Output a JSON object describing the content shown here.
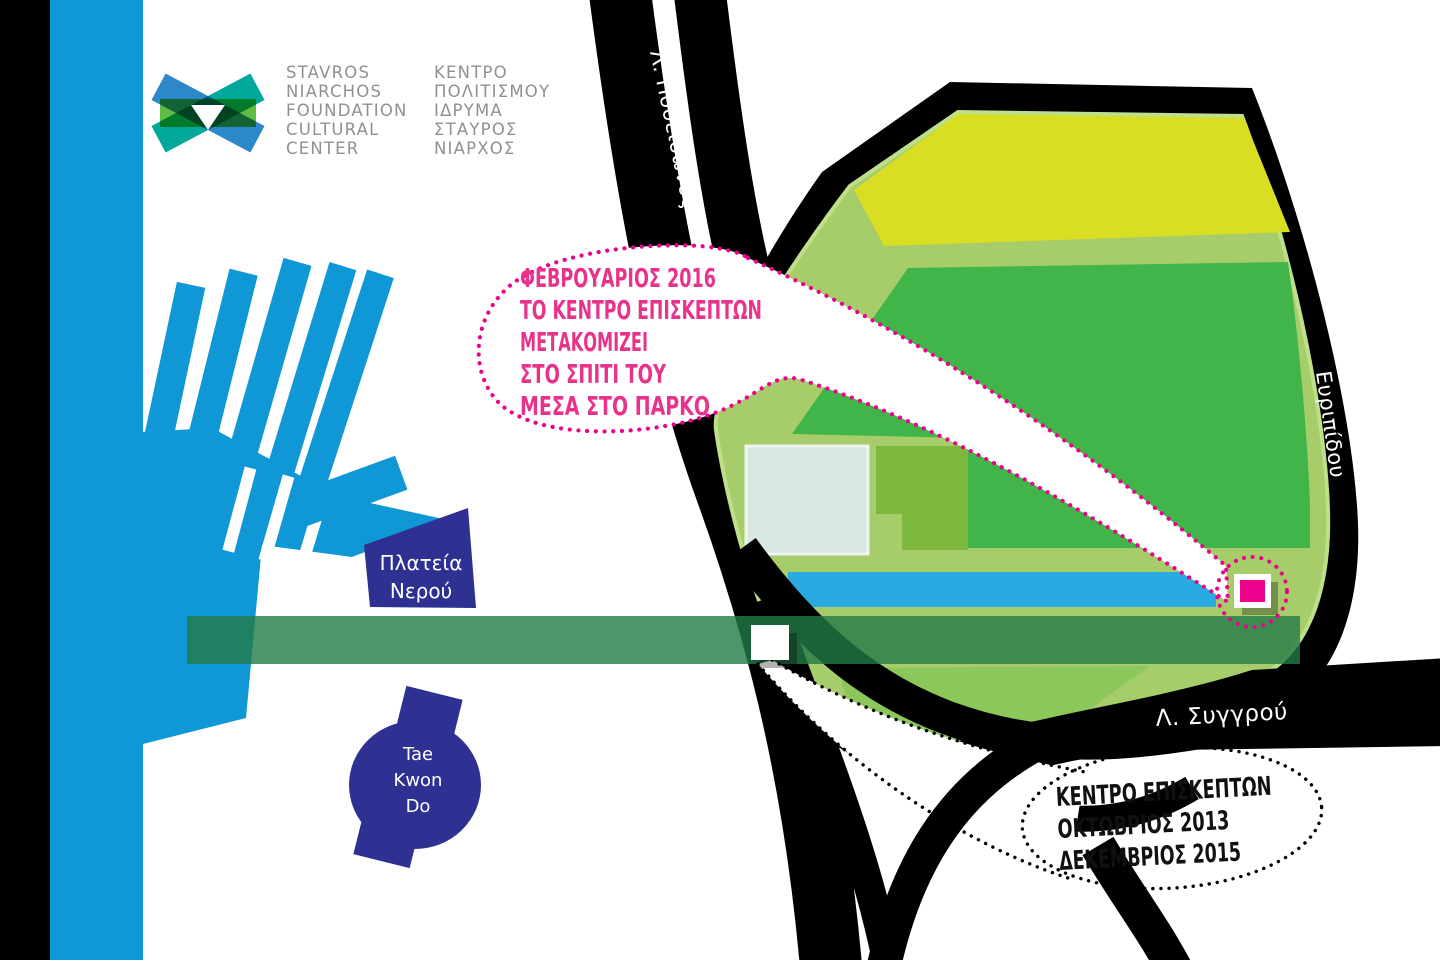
{
  "logo": {
    "name_en": [
      "STAVROS",
      "NIARCHOS",
      "FOUNDATION",
      "CULTURAL",
      "CENTER"
    ],
    "name_el": [
      "ΚΕΝΤΡΟ",
      "ΠΟΛΙΤΙΣΜΟΥ",
      "ΙΔΡΥΜΑ",
      "ΣΤΑΥΡΟΣ",
      "ΝΙΑΡΧΟΣ"
    ]
  },
  "roads": {
    "poseidonos": "Λ. Ποσειδώνος",
    "evripidou": "Ευριπίδου",
    "syggrou": "Λ. Συγγρού"
  },
  "places": {
    "plateia_nerou": {
      "lines": [
        "Πλατεία",
        "Νερού"
      ]
    },
    "tae_kwon_do": {
      "lines": [
        "Tae",
        "Kwon",
        "Do"
      ]
    }
  },
  "callouts": {
    "pink": {
      "lines": [
        "ΦΕΒΡΟΥΑΡΙΟΣ 2016",
        "ΤΟ ΚΕΝΤΡΟ ΕΠΙΣΚΕΠΤΩΝ",
        "ΜΕΤΑΚΟΜΙΖΕΙ",
        "ΣΤΟ ΣΠΙΤΙ ΤΟΥ",
        "ΜΕΣΑ ΣΤΟ ΠΑΡΚΟ"
      ]
    },
    "black": {
      "lines": [
        "ΚΕΝΤΡΟ ΕΠΙΣΚΕΠΤΩΝ",
        "ΟΚΤΩΒΡΙΟΣ 2013",
        "ΔΕΚΕΜΒΡΙΟΣ 2015"
      ]
    }
  },
  "colors": {
    "water_blue": "#1097d5",
    "road_black": "#000000",
    "park_light_green": "#a7cd6a",
    "park_border_green": "#bfdf8a",
    "park_yellow": "#dade22",
    "park_mid_green": "#41b549",
    "park_low_green": "#8cc75b",
    "building_pale": "#d9e9e2",
    "building_olive": "#7db93e",
    "canal_blue": "#29abe2",
    "esplanade_green": "#237b47",
    "navy": "#2e3192",
    "magenta": "#ec008c",
    "pink_text": "#e9338b",
    "logo_blue": "#2d88c9",
    "logo_teal": "#00a89c",
    "logo_green": "#62bb46"
  }
}
